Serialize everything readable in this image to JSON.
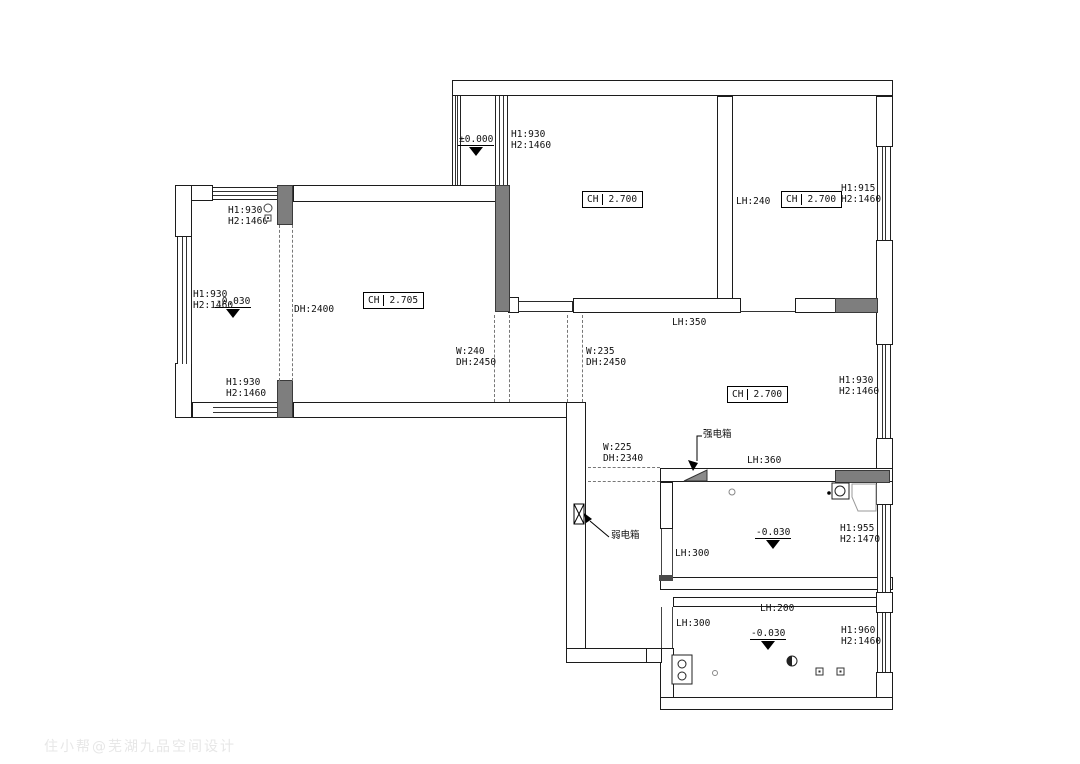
{
  "watermark": "住小帮@芜湖九品空间设计",
  "ch_boxes": {
    "left_wing": {
      "label": "CH",
      "value": "2.705"
    },
    "upper_mid": {
      "label": "CH",
      "value": "2.700"
    },
    "top_right": {
      "label": "CH",
      "value": "2.700"
    },
    "living": {
      "label": "CH",
      "value": "2.700"
    }
  },
  "levels": {
    "entry": "±0.000",
    "left_wing": "-0.030",
    "bath": "-0.030",
    "kitchen": "-0.030"
  },
  "windows": {
    "entry_bay": {
      "h1": "H1:930",
      "h2": "H2:1460"
    },
    "left_wing_top": {
      "h1": "H1:930",
      "h2": "H2:1460"
    },
    "left_wing_left": {
      "h1": "H1:930",
      "h2": "H2:1460"
    },
    "left_wing_bottom": {
      "h1": "H1:930",
      "h2": "H2:1460"
    },
    "top_right": {
      "h1": "H1:915",
      "h2": "H2:1460"
    },
    "living_right": {
      "h1": "H1:930",
      "h2": "H2:1460"
    },
    "bath_right": {
      "h1": "H1:955",
      "h2": "H2:1470"
    },
    "kitchen_right": {
      "h1": "H1:960",
      "h2": "H2:1460"
    }
  },
  "openings": {
    "balcony_door": {
      "dh": "DH:2400"
    },
    "door_240": {
      "w": "W:240",
      "dh": "DH:2450"
    },
    "door_235": {
      "w": "W:235",
      "dh": "DH:2450"
    },
    "door_225": {
      "w": "W:225",
      "dh": "DH:2340"
    }
  },
  "beams": {
    "top_right_room": "LH:240",
    "living_top": "LH:350",
    "bath_top": "LH:360",
    "bath_left": "LH:300",
    "kitchen_top": "LH:200",
    "kitchen_left": "LH:300"
  },
  "equipment": {
    "strong_box": "强电箱",
    "weak_box": "弱电箱"
  }
}
